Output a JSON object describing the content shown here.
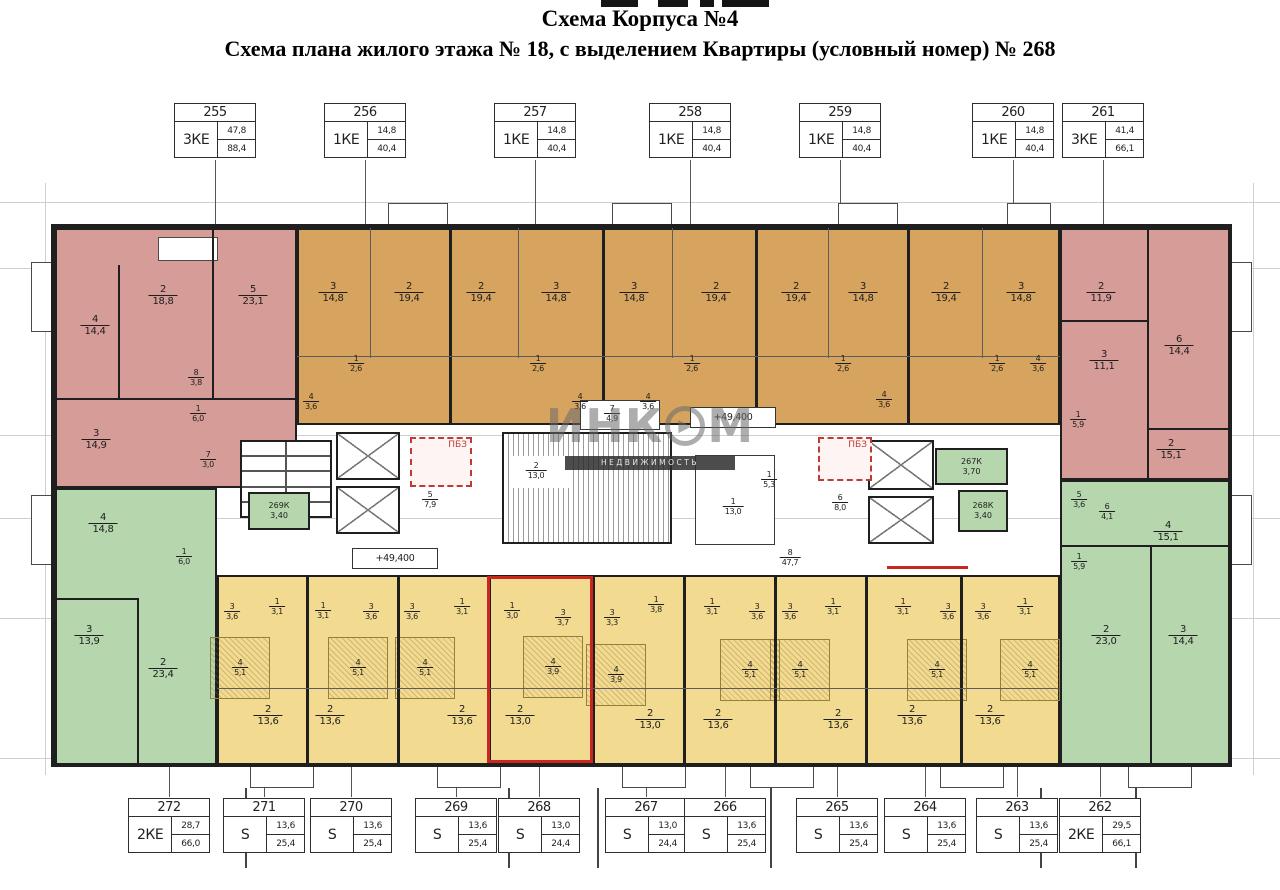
{
  "title": {
    "line1": "Схема Корпуса №4",
    "line2": "Схема плана жилого этажа № 18, с выделением Квартиры (условный номер) № 268"
  },
  "watermark": {
    "brand_left": "ИНК",
    "brand_o": "▶",
    "brand_right": "М",
    "subtitle": "НЕДВИЖИМОСТЬ"
  },
  "colors": {
    "pink": "#d69c98",
    "orange": "#d7a45f",
    "green": "#b6d6ae",
    "yellow": "#f2db90",
    "wall": "#1f1f1f",
    "highlight": "#c9261f",
    "pbz": "#c03a36"
  },
  "pbz_label": "ПБЗ",
  "elevation_mark": "+49,400",
  "highlighted_unit": "268",
  "top_tags": [
    {
      "num": "255",
      "type": "3КЕ",
      "living": "47,8",
      "total": "88,4",
      "cx": 215
    },
    {
      "num": "256",
      "type": "1КЕ",
      "living": "14,8",
      "total": "40,4",
      "cx": 365
    },
    {
      "num": "257",
      "type": "1КЕ",
      "living": "14,8",
      "total": "40,4",
      "cx": 535
    },
    {
      "num": "258",
      "type": "1КЕ",
      "living": "14,8",
      "total": "40,4",
      "cx": 690
    },
    {
      "num": "259",
      "type": "1КЕ",
      "living": "14,8",
      "total": "40,4",
      "cx": 840
    },
    {
      "num": "260",
      "type": "1КЕ",
      "living": "14,8",
      "total": "40,4",
      "cx": 1013
    },
    {
      "num": "261",
      "type": "3КЕ",
      "living": "41,4",
      "total": "66,1",
      "cx": 1103
    }
  ],
  "bottom_tags": [
    {
      "num": "272",
      "type": "2КЕ",
      "living": "28,7",
      "total": "66,0",
      "cx": 169
    },
    {
      "num": "271",
      "type": "S",
      "living": "13,6",
      "total": "25,4",
      "cx": 264
    },
    {
      "num": "270",
      "type": "S",
      "living": "13,6",
      "total": "25,4",
      "cx": 351
    },
    {
      "num": "269",
      "type": "S",
      "living": "13,6",
      "total": "25,4",
      "cx": 456
    },
    {
      "num": "268",
      "type": "S",
      "living": "13,0",
      "total": "24,4",
      "cx": 539
    },
    {
      "num": "267",
      "type": "S",
      "living": "13,0",
      "total": "24,4",
      "cx": 646
    },
    {
      "num": "266",
      "type": "S",
      "living": "13,6",
      "total": "25,4",
      "cx": 725
    },
    {
      "num": "265",
      "type": "S",
      "living": "13,6",
      "total": "25,4",
      "cx": 837
    },
    {
      "num": "264",
      "type": "S",
      "living": "13,6",
      "total": "25,4",
      "cx": 925
    },
    {
      "num": "263",
      "type": "S",
      "living": "13,6",
      "total": "25,4",
      "cx": 1017
    },
    {
      "num": "262",
      "type": "2КЕ",
      "living": "29,5",
      "total": "66,1",
      "cx": 1100
    }
  ],
  "rooms": [
    {
      "n": "4",
      "a": "14,4",
      "x": 95,
      "y": 326
    },
    {
      "n": "2",
      "a": "18,8",
      "x": 163,
      "y": 296
    },
    {
      "n": "5",
      "a": "23,1",
      "x": 253,
      "y": 296
    },
    {
      "n": "8",
      "a": "3,8",
      "x": 196,
      "y": 378,
      "s": 1
    },
    {
      "n": "1",
      "a": "6,0",
      "x": 198,
      "y": 414,
      "s": 1
    },
    {
      "n": "3",
      "a": "14,9",
      "x": 96,
      "y": 440
    },
    {
      "n": "7",
      "a": "3,0",
      "x": 208,
      "y": 460,
      "s": 1
    },
    {
      "n": "4",
      "a": "14,8",
      "x": 103,
      "y": 524
    },
    {
      "n": "1",
      "a": "6,0",
      "x": 184,
      "y": 557,
      "s": 1
    },
    {
      "n": "3",
      "a": "13,9",
      "x": 89,
      "y": 636
    },
    {
      "n": "2",
      "a": "23,4",
      "x": 163,
      "y": 669
    },
    {
      "n": "3",
      "a": "14,8",
      "x": 333,
      "y": 293
    },
    {
      "n": "2",
      "a": "19,4",
      "x": 409,
      "y": 293
    },
    {
      "n": "2",
      "a": "19,4",
      "x": 481,
      "y": 293
    },
    {
      "n": "3",
      "a": "14,8",
      "x": 556,
      "y": 293
    },
    {
      "n": "3",
      "a": "14,8",
      "x": 634,
      "y": 293
    },
    {
      "n": "2",
      "a": "19,4",
      "x": 716,
      "y": 293
    },
    {
      "n": "2",
      "a": "19,4",
      "x": 796,
      "y": 293
    },
    {
      "n": "3",
      "a": "14,8",
      "x": 863,
      "y": 293
    },
    {
      "n": "2",
      "a": "19,4",
      "x": 946,
      "y": 293
    },
    {
      "n": "3",
      "a": "14,8",
      "x": 1021,
      "y": 293
    },
    {
      "n": "1",
      "a": "2,6",
      "x": 356,
      "y": 364,
      "s": 1
    },
    {
      "n": "4",
      "a": "3,6",
      "x": 311,
      "y": 402,
      "s": 1
    },
    {
      "n": "1",
      "a": "2,6",
      "x": 538,
      "y": 364,
      "s": 1
    },
    {
      "n": "4",
      "a": "3,6",
      "x": 580,
      "y": 402,
      "s": 1
    },
    {
      "n": "1",
      "a": "2,6",
      "x": 692,
      "y": 364,
      "s": 1
    },
    {
      "n": "4",
      "a": "3,6",
      "x": 648,
      "y": 402,
      "s": 1
    },
    {
      "n": "1",
      "a": "2,6",
      "x": 843,
      "y": 364,
      "s": 1
    },
    {
      "n": "4",
      "a": "3,6",
      "x": 884,
      "y": 400,
      "s": 1
    },
    {
      "n": "1",
      "a": "2,6",
      "x": 997,
      "y": 364,
      "s": 1
    },
    {
      "n": "4",
      "a": "3,6",
      "x": 1038,
      "y": 364,
      "s": 1
    },
    {
      "n": "2",
      "a": "11,9",
      "x": 1101,
      "y": 293
    },
    {
      "n": "6",
      "a": "14,4",
      "x": 1179,
      "y": 346
    },
    {
      "n": "3",
      "a": "11,1",
      "x": 1104,
      "y": 361
    },
    {
      "n": "1",
      "a": "5,9",
      "x": 1078,
      "y": 420,
      "s": 1
    },
    {
      "n": "2",
      "a": "15,1",
      "x": 1171,
      "y": 450
    },
    {
      "n": "5",
      "a": "3,6",
      "x": 1079,
      "y": 500,
      "s": 1
    },
    {
      "n": "6",
      "a": "4,1",
      "x": 1107,
      "y": 512,
      "s": 1
    },
    {
      "n": "1",
      "a": "5,9",
      "x": 1079,
      "y": 562,
      "s": 1
    },
    {
      "n": "4",
      "a": "15,1",
      "x": 1168,
      "y": 532
    },
    {
      "n": "2",
      "a": "23,0",
      "x": 1106,
      "y": 636
    },
    {
      "n": "3",
      "a": "14,4",
      "x": 1183,
      "y": 636
    },
    {
      "n": "5",
      "a": "7,9",
      "x": 430,
      "y": 500,
      "s": 1
    },
    {
      "n": "2",
      "a": "13,0",
      "x": 536,
      "y": 471,
      "s": 1
    },
    {
      "n": "7",
      "a": "4,9",
      "x": 612,
      "y": 414,
      "s": 1
    },
    {
      "n": "1",
      "a": "13,0",
      "x": 733,
      "y": 507,
      "s": 1
    },
    {
      "n": "1",
      "a": "5,3",
      "x": 769,
      "y": 480,
      "s": 1
    },
    {
      "n": "6",
      "a": "8,0",
      "x": 840,
      "y": 503,
      "s": 1
    },
    {
      "n": "8",
      "a": "47,7",
      "x": 790,
      "y": 558,
      "s": 1
    },
    {
      "n": "3",
      "a": "3,6",
      "x": 232,
      "y": 612,
      "s": 1
    },
    {
      "n": "1",
      "a": "3,1",
      "x": 277,
      "y": 607,
      "s": 1
    },
    {
      "n": "4",
      "a": "5,1",
      "x": 240,
      "y": 668,
      "s": 1
    },
    {
      "n": "2",
      "a": "13,6",
      "x": 268,
      "y": 716
    },
    {
      "n": "1",
      "a": "3,1",
      "x": 323,
      "y": 611,
      "s": 1
    },
    {
      "n": "3",
      "a": "3,6",
      "x": 371,
      "y": 612,
      "s": 1
    },
    {
      "n": "4",
      "a": "5,1",
      "x": 358,
      "y": 668,
      "s": 1
    },
    {
      "n": "2",
      "a": "13,6",
      "x": 330,
      "y": 716
    },
    {
      "n": "3",
      "a": "3,6",
      "x": 412,
      "y": 612,
      "s": 1
    },
    {
      "n": "1",
      "a": "3,1",
      "x": 462,
      "y": 607,
      "s": 1
    },
    {
      "n": "4",
      "a": "5,1",
      "x": 425,
      "y": 668,
      "s": 1
    },
    {
      "n": "2",
      "a": "13,6",
      "x": 462,
      "y": 716
    },
    {
      "n": "1",
      "a": "3,0",
      "x": 512,
      "y": 611,
      "s": 1
    },
    {
      "n": "3",
      "a": "3,7",
      "x": 563,
      "y": 618,
      "s": 1
    },
    {
      "n": "4",
      "a": "3,9",
      "x": 553,
      "y": 667,
      "s": 1
    },
    {
      "n": "2",
      "a": "13,0",
      "x": 520,
      "y": 716
    },
    {
      "n": "3",
      "a": "3,3",
      "x": 612,
      "y": 618,
      "s": 1
    },
    {
      "n": "1",
      "a": "3,8",
      "x": 656,
      "y": 605,
      "s": 1
    },
    {
      "n": "4",
      "a": "3,9",
      "x": 616,
      "y": 675,
      "s": 1
    },
    {
      "n": "2",
      "a": "13,0",
      "x": 650,
      "y": 720
    },
    {
      "n": "1",
      "a": "3,1",
      "x": 712,
      "y": 607,
      "s": 1
    },
    {
      "n": "3",
      "a": "3,6",
      "x": 757,
      "y": 612,
      "s": 1
    },
    {
      "n": "4",
      "a": "5,1",
      "x": 750,
      "y": 670,
      "s": 1
    },
    {
      "n": "2",
      "a": "13,6",
      "x": 718,
      "y": 720
    },
    {
      "n": "3",
      "a": "3,6",
      "x": 790,
      "y": 612,
      "s": 1
    },
    {
      "n": "1",
      "a": "3,1",
      "x": 833,
      "y": 607,
      "s": 1
    },
    {
      "n": "4",
      "a": "5,1",
      "x": 800,
      "y": 670,
      "s": 1
    },
    {
      "n": "2",
      "a": "13,6",
      "x": 838,
      "y": 720
    },
    {
      "n": "1",
      "a": "3,1",
      "x": 903,
      "y": 607,
      "s": 1
    },
    {
      "n": "3",
      "a": "3,6",
      "x": 948,
      "y": 612,
      "s": 1
    },
    {
      "n": "4",
      "a": "5,1",
      "x": 937,
      "y": 670,
      "s": 1
    },
    {
      "n": "2",
      "a": "13,6",
      "x": 912,
      "y": 716
    },
    {
      "n": "3",
      "a": "3,6",
      "x": 983,
      "y": 612,
      "s": 1
    },
    {
      "n": "1",
      "a": "3,1",
      "x": 1025,
      "y": 607,
      "s": 1
    },
    {
      "n": "4",
      "a": "5,1",
      "x": 1030,
      "y": 670,
      "s": 1
    },
    {
      "n": "2",
      "a": "13,6",
      "x": 990,
      "y": 716
    }
  ],
  "core_rooms": [
    {
      "label": "269К",
      "area": "3,40",
      "x": 248,
      "y": 492,
      "w": 62,
      "h": 38
    },
    {
      "label": "267К",
      "area": "3,70",
      "x": 935,
      "y": 448,
      "w": 73,
      "h": 37
    },
    {
      "label": "268К",
      "area": "3,40",
      "x": 958,
      "y": 490,
      "w": 50,
      "h": 42
    }
  ]
}
